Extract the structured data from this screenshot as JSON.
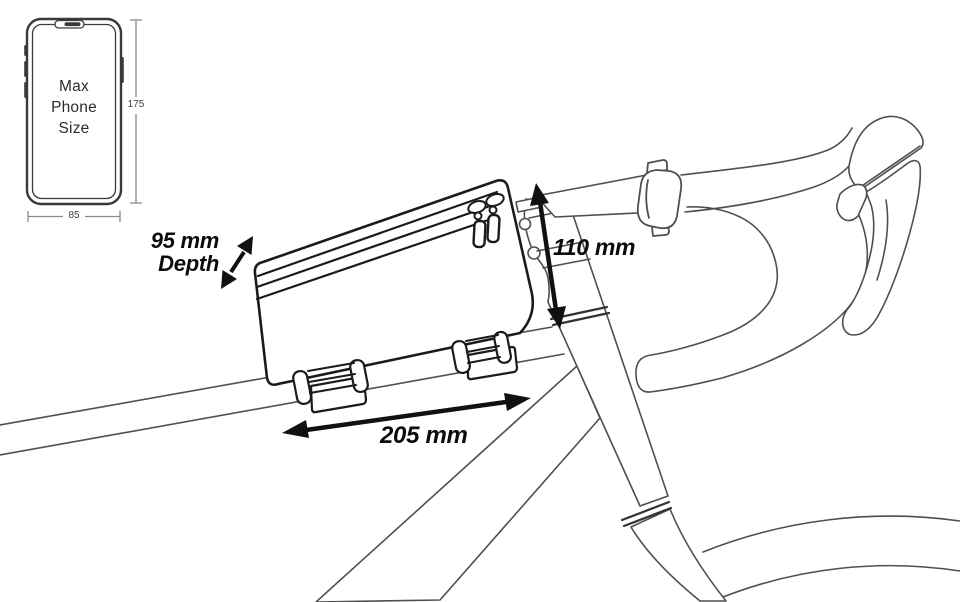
{
  "phone_spec": {
    "label_lines": [
      "Max",
      "Phone",
      "Size"
    ],
    "height_value": "175",
    "width_value": "85"
  },
  "dimensions": {
    "depth_value": "95 mm",
    "depth_word": "Depth",
    "stack_value": "110 mm",
    "length_value": "205 mm"
  },
  "icons": {
    "phone_outline": "max-phone-size-outline",
    "depth_arrow": "double-headed-diagonal-arrow",
    "stack_arrow": "double-headed-vertical-arrow",
    "length_arrow": "double-headed-horizontal-arrow"
  },
  "colors": {
    "background": "#ffffff",
    "ink": "#1b1b1b",
    "bike_line": "#4f4f4f",
    "dim_line": "#8a8a8a",
    "label_text": "#0c0c0c"
  }
}
